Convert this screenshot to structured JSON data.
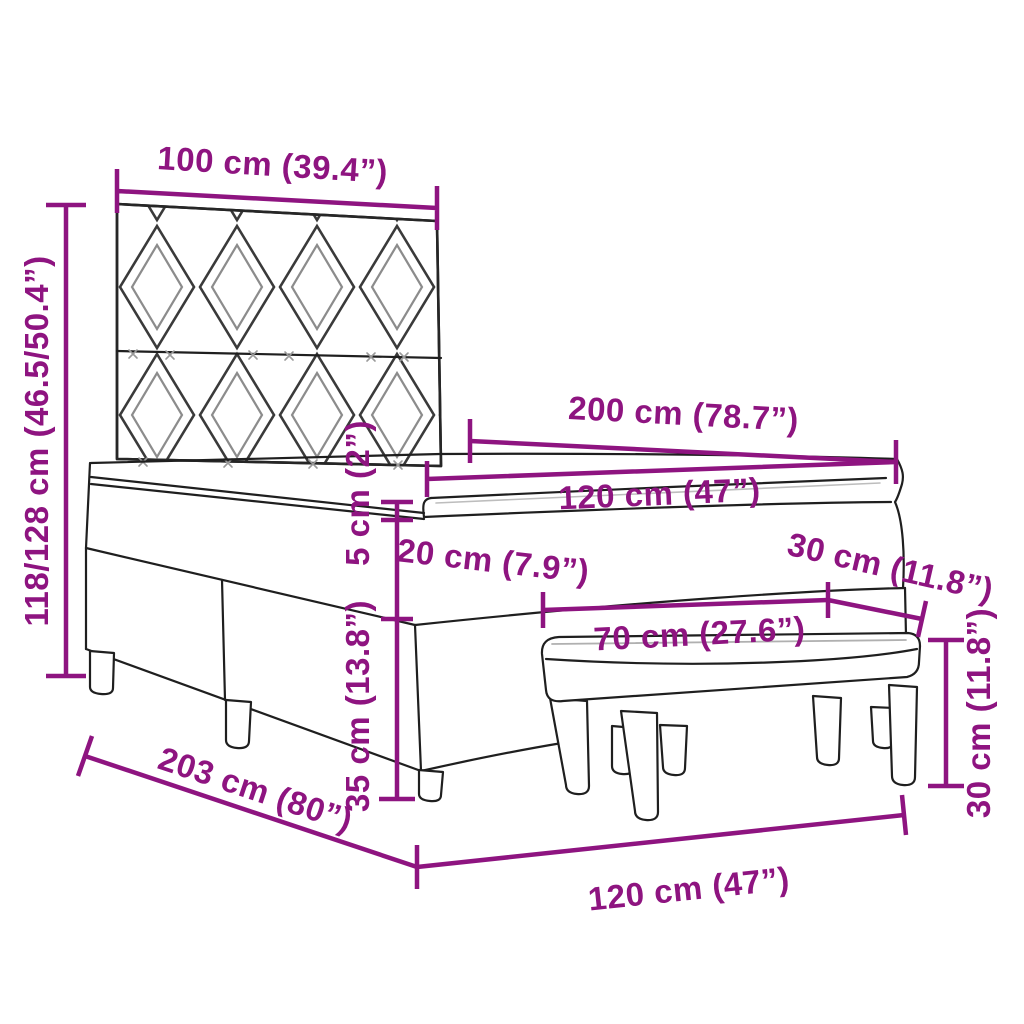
{
  "diagram": {
    "type": "furniture-dimension-diagram",
    "subject": "box spring bed with patterned headboard, mattress topper and bench",
    "background": "#ffffff",
    "accent_color": "#8e1480",
    "line_color": "#1f1f1f",
    "pattern_secondary_color": "#8c8c8c"
  },
  "dimensions": {
    "headboard_width": {
      "label": "100 cm (39.4”)",
      "measures": "headboard width"
    },
    "headboard_height": {
      "label": "118/128 cm (46.5/50.4”)",
      "measures": "headboard height range"
    },
    "bed_length": {
      "label": "200 cm (78.7”)",
      "measures": "mattress length"
    },
    "mattress_width": {
      "label": "120 cm (47”)",
      "measures": "mattress width"
    },
    "topper_height": {
      "label": "5 cm (2”)",
      "measures": "topper thickness"
    },
    "mattress_height": {
      "label": "20 cm (7.9”)",
      "measures": "mattress height"
    },
    "base_height": {
      "label": "35 cm (13.8”)",
      "measures": "bed base height"
    },
    "bench_depth": {
      "label": "30 cm (11.8”)",
      "measures": "bench depth"
    },
    "bench_width": {
      "label": "70 cm (27.6”)",
      "measures": "bench width"
    },
    "bench_height": {
      "label": "30 cm (11.8”)",
      "measures": "bench height"
    },
    "bed_total_length": {
      "label": "203 cm (80”)",
      "measures": "total bed length"
    },
    "bed_total_width": {
      "label": "120 cm (47”)",
      "measures": "total bed width"
    }
  }
}
